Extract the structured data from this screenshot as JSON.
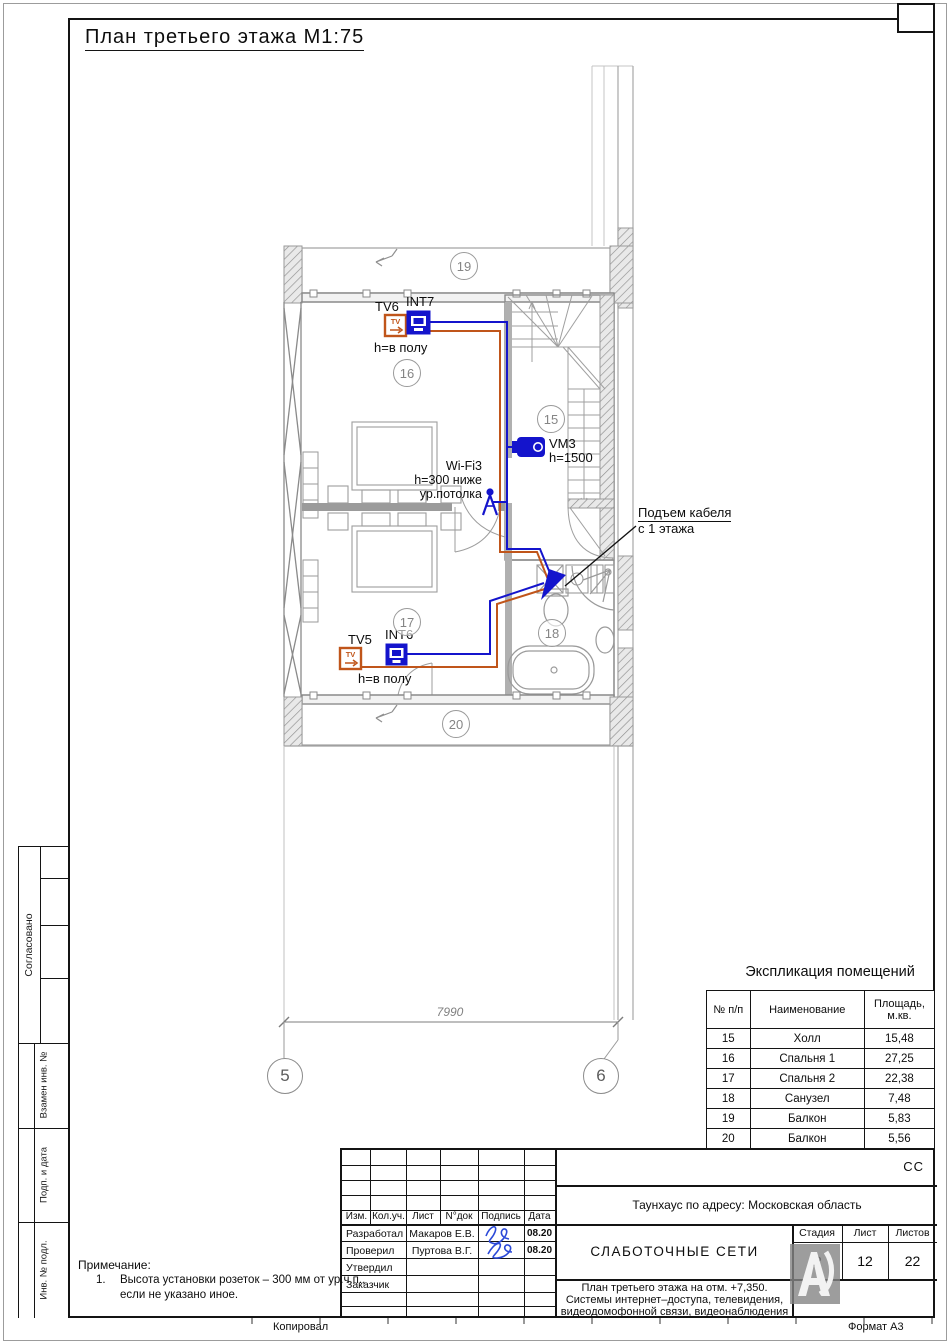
{
  "drawing": {
    "title": "План третьего этажа М1:75"
  },
  "margins": {
    "copied": "Копировал",
    "format": "Формат А3"
  },
  "stamp_side": {
    "agreed": "Согласовано",
    "replace_inv": "Взамен инв. №",
    "sign_date": "Подп. и дата",
    "inv_no": "Инв. № подл."
  },
  "plan": {
    "rooms": {
      "r15": "15",
      "r16": "16",
      "r17": "17",
      "r18": "18",
      "r19": "19",
      "r20": "20"
    },
    "axes": {
      "a5": "5",
      "a6": "6"
    },
    "dim": "7990",
    "labels": {
      "tv6": "TV6",
      "int7": "INT7",
      "tv6_h": "h=в полу",
      "wifi": "Wi-Fi3",
      "wifi_h1": "h=300 ниже",
      "wifi_h2": "ур.потолка",
      "vm3": "VM3",
      "vm3_h": "h=1500",
      "riser1": "Подъем кабеля",
      "riser2": "с 1 этажа",
      "tv5": "TV5",
      "int6": "INT6",
      "tv5_h": "h=в полу"
    },
    "icon_glyphs": {
      "tv": "TV"
    }
  },
  "explication": {
    "title": "Экспликация помещений",
    "headers": {
      "num": "№ п/п",
      "name": "Наименование",
      "area1": "Площадь,",
      "area2": "м.кв."
    },
    "rows": [
      [
        "15",
        "Холл",
        "15,48"
      ],
      [
        "16",
        "Спальня 1",
        "27,25"
      ],
      [
        "17",
        "Спальня 2",
        "22,38"
      ],
      [
        "18",
        "Санузел",
        "7,48"
      ],
      [
        "19",
        "Балкон",
        "5,83"
      ],
      [
        "20",
        "Балкон",
        "5,56"
      ]
    ]
  },
  "titleblock": {
    "code": "СС",
    "object": "Таунхаус по адресу: Московская область",
    "cols": {
      "izm": "Изм.",
      "koluch": "Кол.уч.",
      "list": "Лист",
      "ndoc": "N°док",
      "sign": "Подпись",
      "date": "Дата"
    },
    "rows": [
      {
        "role": "Разработал",
        "name": "Макаров Е.В.",
        "date": "08.20"
      },
      {
        "role": "Проверил",
        "name": "Пуртова В.Г.",
        "date": "08.20"
      },
      {
        "role": "Утвердил",
        "name": "",
        "date": ""
      },
      {
        "role": "Заказчик",
        "name": "",
        "date": ""
      }
    ],
    "doc": "СЛАБОТОЧНЫЕ СЕТИ",
    "stage_h": "Стадия",
    "sheet_h": "Лист",
    "sheets_h": "Листов",
    "stage": "Р",
    "sheet": "12",
    "sheets": "22",
    "desc1": "План третьего этажа на отм. +7,350.",
    "desc2": "Системы интернет–доступа, телевидения,",
    "desc3": "видеодомофонной связи, видеонаблюдения"
  },
  "note": {
    "head": "Примечание:",
    "n1": "1.",
    "l1": "Высота установки розеток – 300 мм от ур.ч.п.,",
    "l2": "если не указано иное."
  },
  "colors": {
    "cable_data": "#1414cc",
    "cable_tv": "#c0551a",
    "signature": "#2b49d8",
    "plan_gray": "#8a8a8a"
  }
}
